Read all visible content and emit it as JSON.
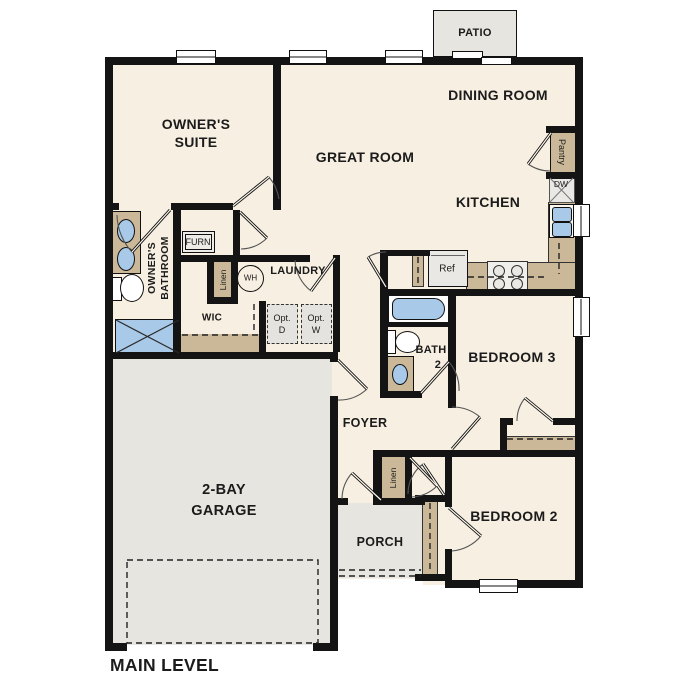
{
  "plan": {
    "level_title": "MAIN LEVEL"
  },
  "rooms": {
    "patio": "PATIO",
    "dining_room": "DINING ROOM",
    "owners_suite_line1": "OWNER'S",
    "owners_suite_line2": "SUITE",
    "great_room": "GREAT ROOM",
    "kitchen": "KITCHEN",
    "owners_bath_line1": "OWNER'S",
    "owners_bath_line2": "BATHROOM",
    "wic": "WIC",
    "laundry": "LAUNDRY",
    "bath2_line1": "BATH",
    "bath2_line2": "2",
    "bedroom3": "BEDROOM 3",
    "bedroom2": "BEDROOM 2",
    "foyer": "FOYER",
    "garage_line1": "2-BAY",
    "garage_line2": "GARAGE",
    "porch": "PORCH"
  },
  "closets": {
    "pantry": "Pantry",
    "linen_bathroom": "Linen",
    "linen_hallway": "Linen",
    "furnace": "FURN"
  },
  "appliances": {
    "dishwasher": "DW",
    "refrigerator": "Ref",
    "water_heater": "WH",
    "optional_dryer_line1": "Opt.",
    "optional_dryer_line2": "D",
    "optional_washer_line1": "Opt.",
    "optional_washer_line2": "W"
  },
  "colors": {
    "wall": "#141414",
    "floor": "#f7efe2",
    "concrete": "#e7e5e0",
    "cabinet": "#cab898",
    "plumbing": "#a9c9e9",
    "appliance_fill": "#e9e8e4",
    "text": "#1b1b1b"
  }
}
